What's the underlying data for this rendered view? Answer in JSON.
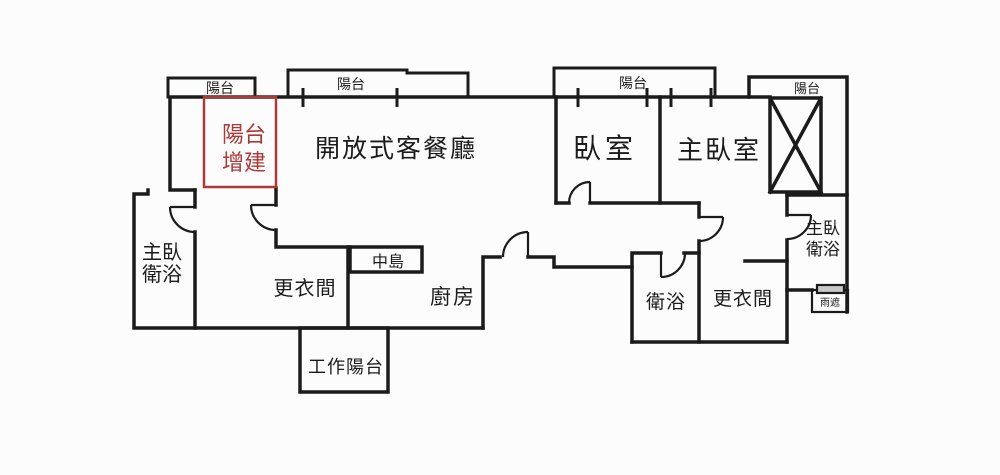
{
  "page": {
    "background": "#fcfcfc"
  },
  "colors": {
    "wall": "#1b1b1b",
    "text": "#1b1b1b",
    "addition_red": "#a93a38",
    "window_fill": "#c9c9c9"
  },
  "plan": {
    "balconies": {
      "b1": "陽台",
      "b2": "陽台",
      "b3": "陽台",
      "b4": "陽台"
    },
    "balcony_addition": {
      "line1": "陽台",
      "line2": "增建"
    },
    "rooms": {
      "living_dining": "開放式客餐廳",
      "bedroom": "臥室",
      "master_bedroom": "主臥室",
      "master_bath_left": {
        "line1": "主臥",
        "line2": "衛浴"
      },
      "closet_left": "更衣間",
      "island": "中島",
      "kitchen": "廚房",
      "work_balcony": "工作陽台",
      "bathroom": "衛浴",
      "closet_right": "更衣間",
      "master_bath_right": {
        "line1": "主臥",
        "line2": "衛浴"
      },
      "rain_cover": "雨遮"
    }
  }
}
